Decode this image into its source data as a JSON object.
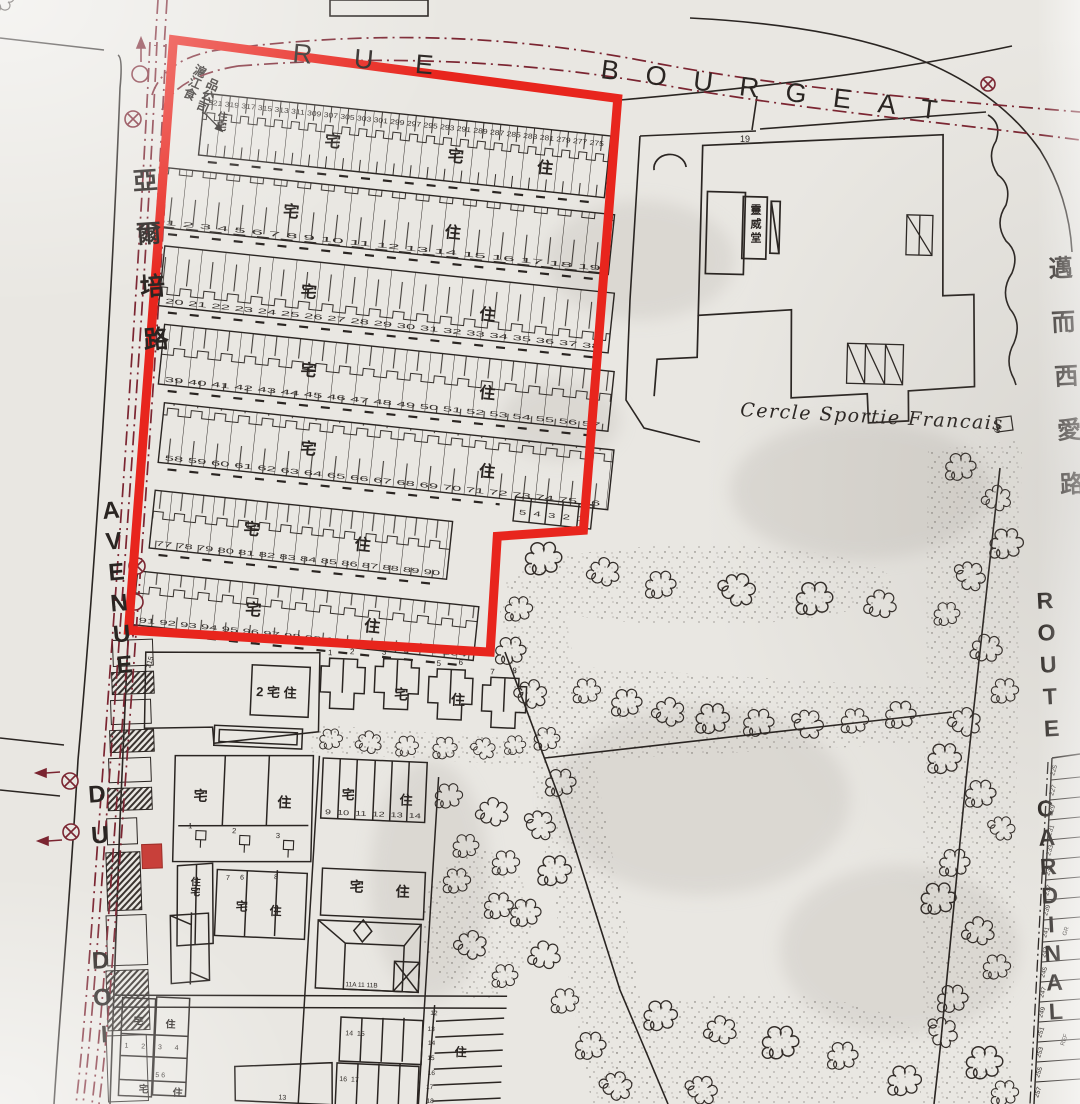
{
  "colors": {
    "paper": "#e9e7e2",
    "ink": "#2a2522",
    "red": "#e8251d",
    "tram": "#7b2531"
  },
  "streets": {
    "rue": {
      "word1": "RUE",
      "word2": "BOURGEAT"
    },
    "avenue": {
      "cn": "亞爾培路",
      "en1": "AVENUE",
      "en2": "DU",
      "en3": "DOI"
    },
    "cardinal": {
      "cn": "邁而西愛路",
      "en1": "ROUTE",
      "en2": "CARDINAL"
    }
  },
  "chars": {
    "zhai": "宅",
    "zhu": "住",
    "zhuzhai": "住宅"
  },
  "landmarks": {
    "cercle": "Cercle Sportie Francais",
    "chapel": "靈威堂",
    "company1": "滬江食",
    "company2": "品公司",
    "n19": "19",
    "n68": "68",
    "n215": "215"
  },
  "block": {
    "row1": [
      "321",
      "319",
      "317",
      "315",
      "313",
      "311",
      "309",
      "307",
      "305",
      "303",
      "301",
      "299",
      "297",
      "295",
      "293",
      "291",
      "289",
      "287",
      "285",
      "283",
      "281",
      "279",
      "277",
      "275"
    ],
    "row2": [
      "1",
      "2",
      "3",
      "4",
      "5",
      "6",
      "7",
      "8",
      "9",
      "10",
      "11",
      "12",
      "13",
      "14",
      "15",
      "16",
      "17",
      "18",
      "19"
    ],
    "row3": [
      "20",
      "21",
      "22",
      "23",
      "24",
      "25",
      "26",
      "27",
      "28",
      "29",
      "30",
      "31",
      "32",
      "33",
      "34",
      "35",
      "36",
      "37",
      "38"
    ],
    "row4": [
      "39",
      "40",
      "41",
      "42",
      "43",
      "44",
      "45",
      "46",
      "47",
      "48",
      "49",
      "50",
      "51",
      "52",
      "53",
      "54",
      "55",
      "56",
      "57"
    ],
    "row5": [
      "58",
      "59",
      "60",
      "61",
      "62",
      "63",
      "64",
      "65",
      "66",
      "67",
      "68",
      "69",
      "70",
      "71",
      "72",
      "73",
      "74",
      "75",
      "76"
    ],
    "row6": [
      "77",
      "78",
      "79",
      "80",
      "81",
      "82",
      "83",
      "84",
      "85",
      "86",
      "87",
      "88",
      "89",
      "90"
    ],
    "row7": [
      "91",
      "92",
      "93",
      "94",
      "95",
      "96",
      "97",
      "98",
      "99",
      "100",
      "101",
      "102",
      "103",
      "104"
    ],
    "strip": [
      "5",
      "4",
      "3",
      "2",
      "1"
    ]
  },
  "south": {
    "plot2_label": "2 宅 住",
    "villa_numbers": [
      "1",
      "2",
      "3",
      "4",
      "5",
      "6",
      "7",
      "8"
    ],
    "units3": [
      "1",
      "2",
      "3"
    ],
    "lots9_14": [
      "9",
      "10",
      "11",
      "12",
      "13",
      "14"
    ],
    "left_numbers": [
      "7",
      "6",
      "8"
    ],
    "villa11_label": "11A 11 11B",
    "rows1415": [
      "14",
      "15"
    ],
    "rows1617": [
      "16",
      "17"
    ],
    "strip1218": [
      "12",
      "13",
      "14",
      "15",
      "16",
      "17",
      "18"
    ],
    "tiny1234": [
      "1",
      "2",
      "3",
      "4"
    ],
    "tiny56": [
      "5",
      "6"
    ],
    "n13": "13"
  },
  "east_strip": {
    "numbers": [
      "225",
      "227",
      "229",
      "231",
      "233",
      "235",
      "237",
      "239",
      "241",
      "243",
      "245",
      "247",
      "249",
      "251",
      "253",
      "255",
      "257"
    ],
    "t1": "GR",
    "t2": "REF"
  }
}
